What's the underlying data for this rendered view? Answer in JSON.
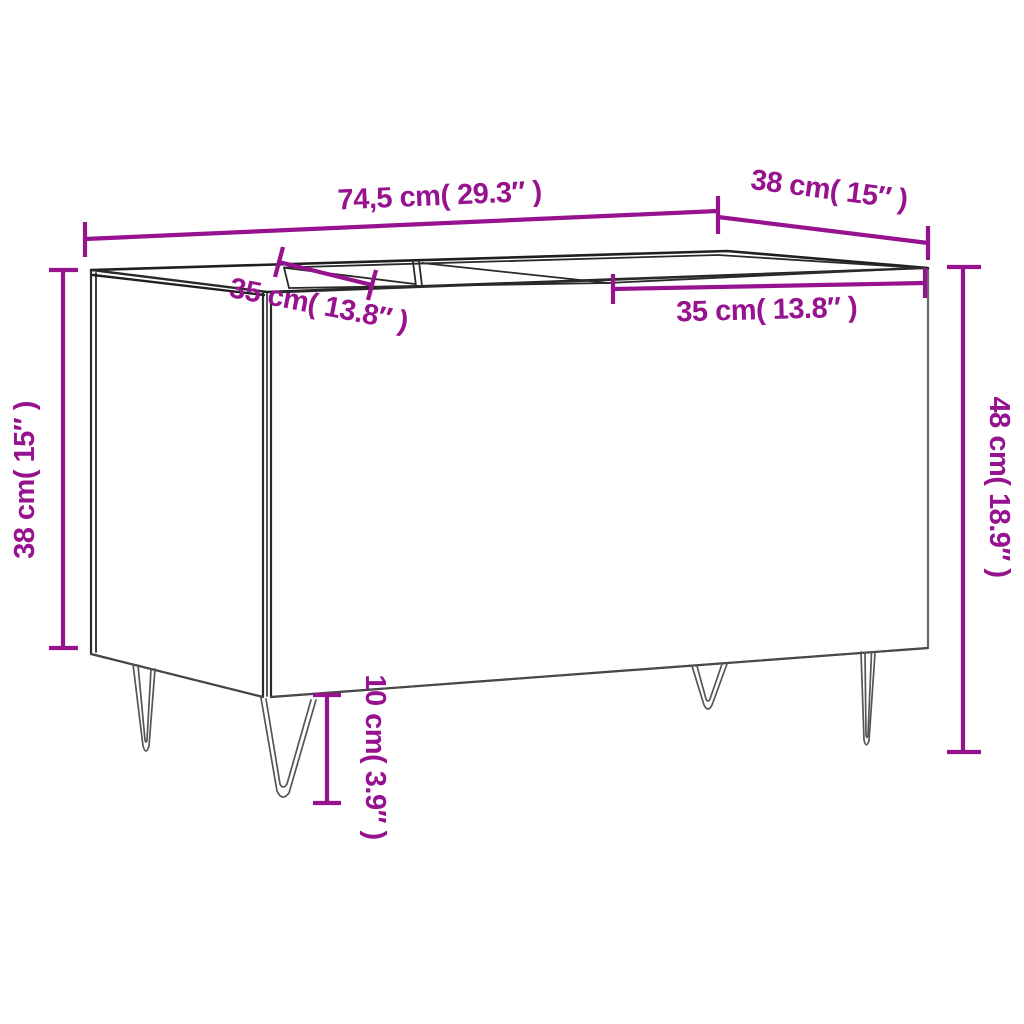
{
  "diagram": {
    "accent_color": "#96128E",
    "edge_color": "#1f1f1f",
    "background_color": "#ffffff",
    "labels": {
      "overall_width": "74,5 cm( 29.3″ )",
      "depth": "38 cm( 15″ )",
      "height_left": "38 cm( 15″ )",
      "height_right": "48 cm( 18.9″ )",
      "compartment_left": "35 cm( 13.8″ )",
      "compartment_right": "35 cm( 13.8″ )",
      "leg_height": "10 cm( 3.9″ )"
    }
  }
}
